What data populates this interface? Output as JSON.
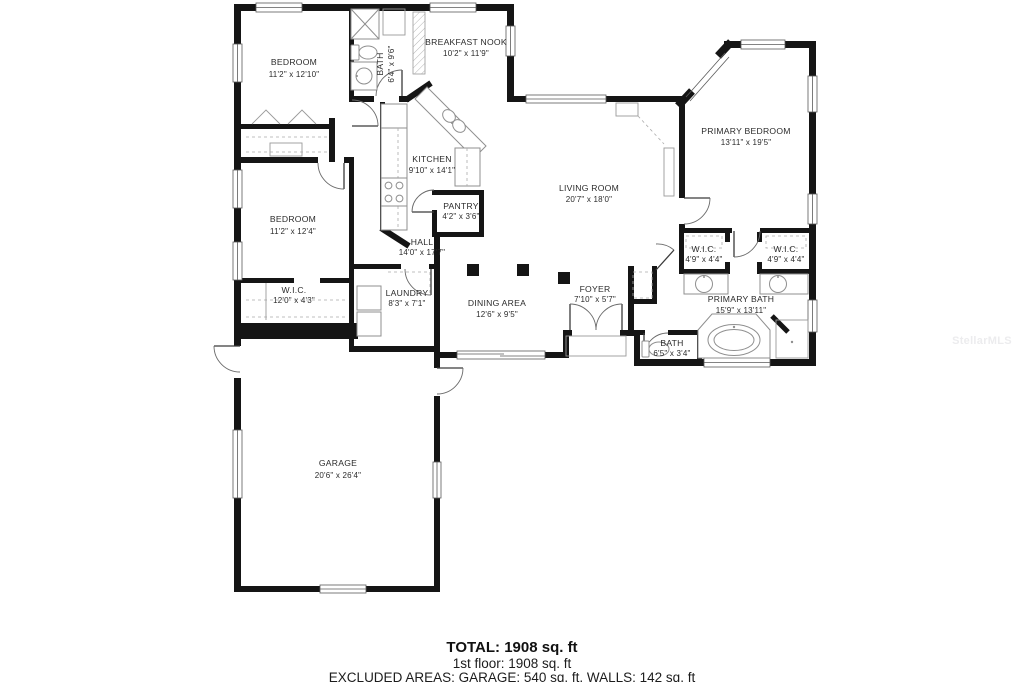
{
  "plan": {
    "watermark": "StellarMLS",
    "footer": {
      "total": "TOTAL: 1908 sq. ft",
      "floor1": "1st floor: 1908 sq. ft",
      "excluded": "EXCLUDED AREAS: GARAGE: 540 sq. ft, WALLS: 142 sq. ft"
    },
    "rooms": {
      "bedroom1": {
        "name": "BEDROOM",
        "dims": "11'2\" x 12'10\""
      },
      "bath1": {
        "name": "BATH",
        "dims": "6'4\" x 9'6\""
      },
      "breakfast_nook": {
        "name": "BREAKFAST NOOK",
        "dims": "10'2\" x 11'9\""
      },
      "kitchen": {
        "name": "KITCHEN",
        "dims": "9'10\" x 14'1\""
      },
      "pantry": {
        "name": "PANTRY",
        "dims": "4'2\" x 3'6\""
      },
      "living_room": {
        "name": "LIVING ROOM",
        "dims": "20'7\" x 18'0\""
      },
      "primary_bedroom": {
        "name": "PRIMARY BEDROOM",
        "dims": "13'11\" x 19'5\""
      },
      "hall": {
        "name": "HALL",
        "dims": "14'0\" x 17'7\""
      },
      "bedroom2": {
        "name": "BEDROOM",
        "dims": "11'2\" x 12'4\""
      },
      "wic_left": {
        "name": "W.I.C.",
        "dims": "12'0\" x 4'3\""
      },
      "laundry": {
        "name": "LAUNDRY",
        "dims": "8'3\" x 7'1\""
      },
      "dining": {
        "name": "DINING AREA",
        "dims": "12'6\" x 9'5\""
      },
      "foyer": {
        "name": "FOYER",
        "dims": "7'10\" x 5'7\""
      },
      "wic1": {
        "name": "W.I.C.",
        "dims": "4'9\" x 4'4\""
      },
      "wic2": {
        "name": "W.I.C.",
        "dims": "4'9\" x 4'4\""
      },
      "primary_bath": {
        "name": "PRIMARY BATH",
        "dims": "15'9\" x 13'11\""
      },
      "bath2": {
        "name": "BATH",
        "dims": "6'5\" x 3'4\""
      },
      "garage": {
        "name": "GARAGE",
        "dims": "20'6\" x 26'4\""
      }
    },
    "colors": {
      "wall": "#151515",
      "label": "#2b2b2b",
      "fixture": "#8f8f8f",
      "watermark": "#ececee"
    }
  }
}
